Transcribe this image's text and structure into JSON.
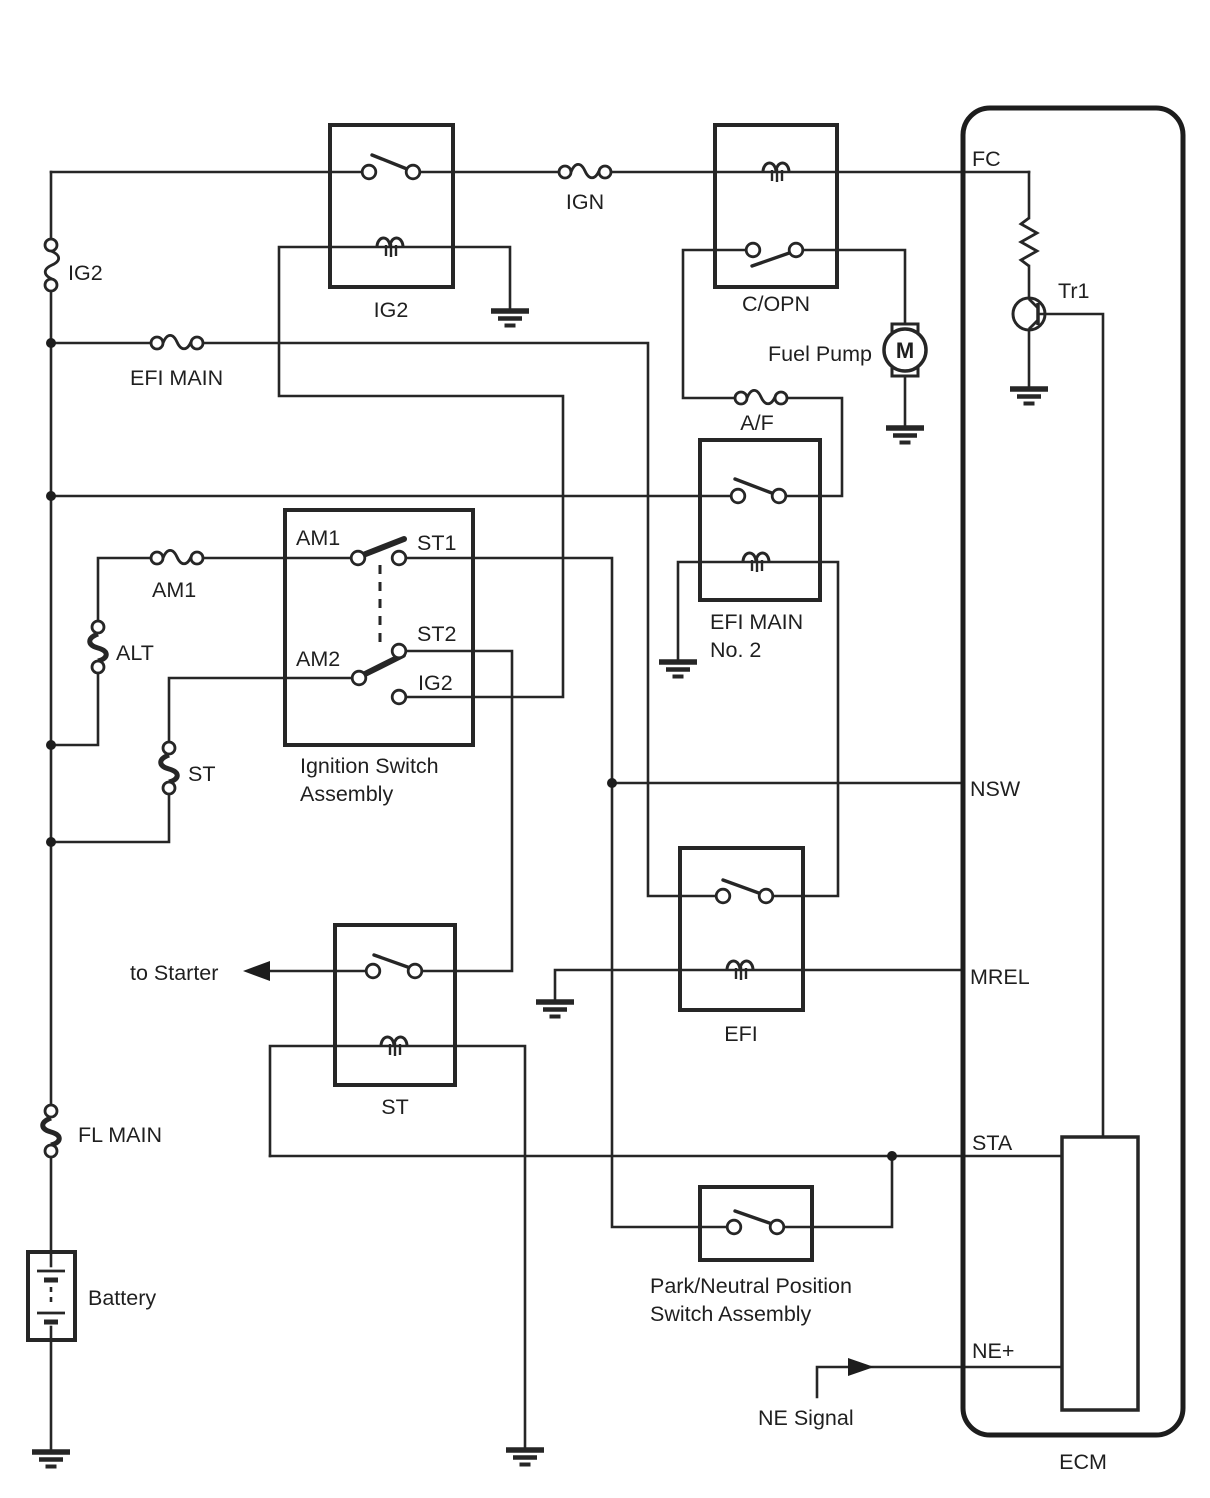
{
  "colors": {
    "line": "#262626",
    "text": "#1f1f1f",
    "background": "#ffffff"
  },
  "fuses": {
    "ig2": "IG2",
    "efi_main": "EFI MAIN",
    "am1": "AM1",
    "ign": "IGN",
    "af": "A/F"
  },
  "links": {
    "alt": "ALT",
    "st": "ST",
    "fl_main": "FL MAIN"
  },
  "relays": {
    "ig2": "IG2",
    "copn": "C/OPN",
    "efi_main_no2_line1": "EFI MAIN",
    "efi_main_no2_line2": "No. 2",
    "efi": "EFI",
    "st": "ST"
  },
  "ignition_switch": {
    "am1": "AM1",
    "st1": "ST1",
    "am2": "AM2",
    "st2": "ST2",
    "ig2": "IG2",
    "caption_line1": "Ignition Switch",
    "caption_line2": "Assembly"
  },
  "pnp_switch": {
    "caption_line1": "Park/Neutral Position",
    "caption_line2": "Switch Assembly"
  },
  "ecm": {
    "label": "ECM",
    "fc": "FC",
    "nsw": "NSW",
    "mrel": "MREL",
    "sta": "STA",
    "ne_plus": "NE+",
    "tr1": "Tr1"
  },
  "components": {
    "fuel_pump": "Fuel Pump",
    "motor": "M",
    "battery": "Battery"
  },
  "annotations": {
    "to_starter": "to Starter",
    "ne_signal": "NE Signal"
  }
}
